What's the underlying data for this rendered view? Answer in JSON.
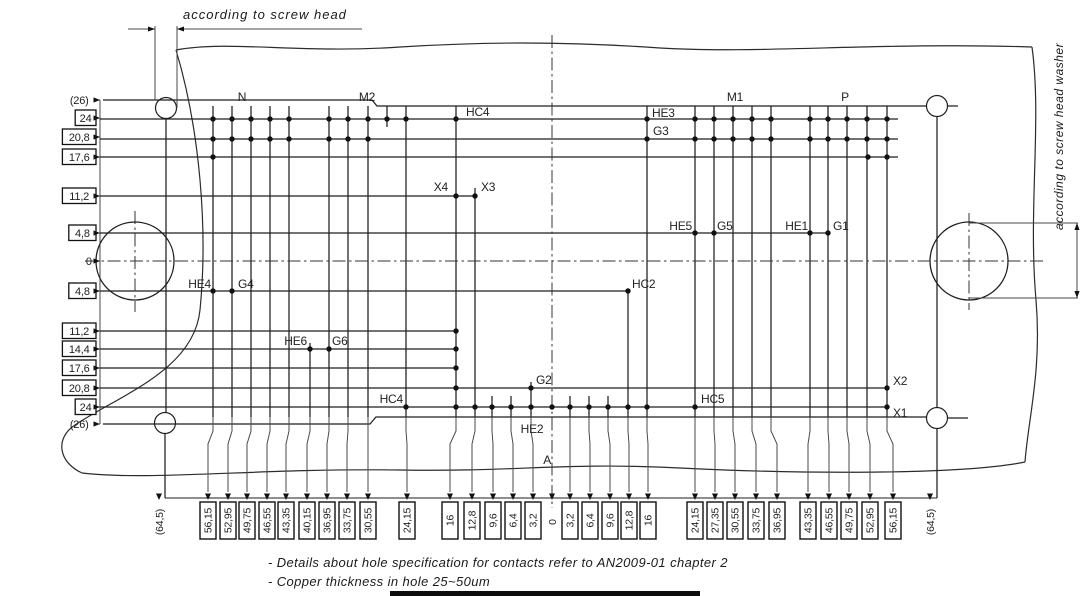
{
  "annotations": {
    "screw_head": "according to screw head",
    "screw_washer": "according to screw head washer"
  },
  "notes": [
    "- Details about hole specification for contacts refer to AN2009-01 chapter 2",
    "- Copper thickness in hole 25~50um"
  ],
  "colors": {
    "line": "#1f1f1f",
    "leader": "#4a4a4a",
    "text": "#222222",
    "background": "#ffffff",
    "bottom_bar": "#0d0d0d"
  },
  "left_dimensions": [
    {
      "label": "(26)",
      "y": 100,
      "boxed": false
    },
    {
      "label": "24",
      "y": 118,
      "boxed": true
    },
    {
      "label": "20,8",
      "y": 137,
      "boxed": true
    },
    {
      "label": "17,6",
      "y": 157,
      "boxed": true
    },
    {
      "label": "11,2",
      "y": 196,
      "boxed": true
    },
    {
      "label": "4,8",
      "y": 233,
      "boxed": true
    },
    {
      "label": "0",
      "y": 261,
      "boxed": false
    },
    {
      "label": "4,8",
      "y": 291,
      "boxed": true
    },
    {
      "label": "11,2",
      "y": 331,
      "boxed": true
    },
    {
      "label": "14,4",
      "y": 349,
      "boxed": true
    },
    {
      "label": "17,6",
      "y": 368,
      "boxed": true
    },
    {
      "label": "20,8",
      "y": 388,
      "boxed": true
    },
    {
      "label": "24",
      "y": 407,
      "boxed": true
    },
    {
      "label": "(26)",
      "y": 424,
      "boxed": false
    }
  ],
  "bottom_dimensions": [
    {
      "label": "(64,5)",
      "col": 165,
      "x": 159,
      "boxed": false
    },
    {
      "label": "56,15",
      "col": 213,
      "x": 208,
      "boxed": true
    },
    {
      "label": "52,95",
      "col": 232,
      "x": 228,
      "boxed": true
    },
    {
      "label": "49,75",
      "col": 251,
      "x": 247,
      "boxed": true
    },
    {
      "label": "46,55",
      "col": 270,
      "x": 267,
      "boxed": true
    },
    {
      "label": "43,35",
      "col": 289,
      "x": 286,
      "boxed": true
    },
    {
      "label": "40,15",
      "col": 310,
      "x": 307,
      "boxed": true
    },
    {
      "label": "36,95",
      "col": 329,
      "x": 327,
      "boxed": true
    },
    {
      "label": "33,75",
      "col": 348,
      "x": 347,
      "boxed": true
    },
    {
      "label": "30,55",
      "col": 368,
      "x": 368,
      "boxed": true
    },
    {
      "label": "24,15",
      "col": 406,
      "x": 407,
      "boxed": true
    },
    {
      "label": "16",
      "col": 456,
      "x": 450,
      "boxed": true
    },
    {
      "label": "12,8",
      "col": 475,
      "x": 472,
      "boxed": true
    },
    {
      "label": "9,6",
      "col": 492,
      "x": 493,
      "boxed": true
    },
    {
      "label": "6,4",
      "col": 511,
      "x": 513,
      "boxed": true
    },
    {
      "label": "3,2",
      "col": 531,
      "x": 533,
      "boxed": true
    },
    {
      "label": "0",
      "col": 552,
      "x": 552,
      "boxed": false
    },
    {
      "label": "3,2",
      "col": 570,
      "x": 570,
      "boxed": true
    },
    {
      "label": "6,4",
      "col": 589,
      "x": 590,
      "boxed": true
    },
    {
      "label": "9,6",
      "col": 608,
      "x": 610,
      "boxed": true
    },
    {
      "label": "12,8",
      "col": 628,
      "x": 629,
      "boxed": true
    },
    {
      "label": "16",
      "col": 647,
      "x": 648,
      "boxed": true
    },
    {
      "label": "24,15",
      "col": 695,
      "x": 695,
      "boxed": true
    },
    {
      "label": "27,35",
      "col": 714,
      "x": 715,
      "boxed": true
    },
    {
      "label": "30,55",
      "col": 733,
      "x": 735,
      "boxed": true
    },
    {
      "label": "33,75",
      "col": 752,
      "x": 756,
      "boxed": true
    },
    {
      "label": "36,95",
      "col": 771,
      "x": 777,
      "boxed": true
    },
    {
      "label": "43,35",
      "col": 810,
      "x": 808,
      "boxed": true
    },
    {
      "label": "46,55",
      "col": 828,
      "x": 829,
      "boxed": true
    },
    {
      "label": "49,75",
      "col": 847,
      "x": 849,
      "boxed": true
    },
    {
      "label": "52,95",
      "col": 867,
      "x": 870,
      "boxed": true
    },
    {
      "label": "56,15",
      "col": 887,
      "x": 893,
      "boxed": true
    },
    {
      "label": "(64,5)",
      "col": 937,
      "x": 930,
      "boxed": false
    }
  ],
  "part_labels": [
    {
      "text": "N",
      "x": 242,
      "y": 101,
      "anchor": "middle"
    },
    {
      "text": "M2",
      "x": 367,
      "y": 101,
      "anchor": "middle"
    },
    {
      "text": "HC4",
      "x": 466,
      "y": 116,
      "anchor": "start"
    },
    {
      "text": "HE3",
      "x": 652,
      "y": 117,
      "anchor": "start"
    },
    {
      "text": "G3",
      "x": 653,
      "y": 135,
      "anchor": "start"
    },
    {
      "text": "M1",
      "x": 735,
      "y": 101,
      "anchor": "middle"
    },
    {
      "text": "P",
      "x": 845,
      "y": 101,
      "anchor": "middle"
    },
    {
      "text": "X4",
      "x": 448,
      "y": 191,
      "anchor": "end"
    },
    {
      "text": "X3",
      "x": 481,
      "y": 191,
      "anchor": "start"
    },
    {
      "text": "HE5",
      "x": 692,
      "y": 230,
      "anchor": "end"
    },
    {
      "text": "G5",
      "x": 717,
      "y": 230,
      "anchor": "start"
    },
    {
      "text": "HE1",
      "x": 808,
      "y": 230,
      "anchor": "end"
    },
    {
      "text": "G1",
      "x": 833,
      "y": 230,
      "anchor": "start"
    },
    {
      "text": "HE4",
      "x": 211,
      "y": 288,
      "anchor": "end"
    },
    {
      "text": "G4",
      "x": 238,
      "y": 288,
      "anchor": "start"
    },
    {
      "text": "HC2",
      "x": 632,
      "y": 288,
      "anchor": "start"
    },
    {
      "text": "HE6",
      "x": 307,
      "y": 345,
      "anchor": "end"
    },
    {
      "text": "G6",
      "x": 332,
      "y": 345,
      "anchor": "start"
    },
    {
      "text": "G2",
      "x": 536,
      "y": 384,
      "anchor": "start"
    },
    {
      "text": "HC5",
      "x": 701,
      "y": 403,
      "anchor": "start"
    },
    {
      "text": "X2",
      "x": 893,
      "y": 385,
      "anchor": "start"
    },
    {
      "text": "X1",
      "x": 893,
      "y": 417,
      "anchor": "start"
    },
    {
      "text": "HC4",
      "x": 403,
      "y": 403,
      "anchor": "end"
    },
    {
      "text": "HE2",
      "x": 532,
      "y": 433,
      "anchor": "middle"
    },
    {
      "text": "A",
      "x": 551,
      "y": 464,
      "anchor": "end"
    }
  ],
  "drawing": {
    "outline_paths": [
      "M 176 50 C 230 40 300 54 400 47 C 480 42 560 41 660 48 C 760 54 880 42 1032 47",
      "M 176 50 C 200 130 208 230 200 310 C 194 370 120 395 75 425 C 55 438 58 462 82 473",
      "M 82 473 C 150 481 260 468 400 470 C 520 472 560 462 680 468 C 800 474 960 475 1025 462",
      "M 1032 47 C 1042 120 1028 210 1036 300 C 1042 370 1028 420 1025 462"
    ],
    "rows": [
      [
        100,
        898,
        119
      ],
      [
        100,
        898,
        139
      ],
      [
        100,
        898,
        157
      ],
      [
        100,
        475,
        196
      ],
      [
        100,
        828,
        233
      ],
      [
        100,
        628,
        291
      ],
      [
        100,
        455,
        331
      ],
      [
        100,
        455,
        349
      ],
      [
        100,
        455,
        368
      ],
      [
        100,
        887,
        388
      ],
      [
        100,
        887,
        407
      ]
    ],
    "profile": [
      [
        [
          103,
          100
        ],
        [
          372,
          100
        ],
        [
          377,
          106
        ],
        [
          926,
          106
        ]
      ],
      [
        [
          947,
          106
        ],
        [
          958,
          106
        ]
      ],
      [
        [
          103,
          424
        ],
        [
          370,
          424
        ],
        [
          376,
          417
        ],
        [
          926,
          417
        ]
      ],
      [
        [
          948,
          418
        ],
        [
          968,
          418
        ]
      ]
    ],
    "cols": [
      [
        213,
        106,
        417
      ],
      [
        232,
        106,
        417
      ],
      [
        251,
        106,
        417
      ],
      [
        270,
        106,
        417
      ],
      [
        289,
        106,
        417
      ],
      [
        310,
        343,
        417
      ],
      [
        329,
        106,
        417
      ],
      [
        348,
        106,
        417
      ],
      [
        368,
        106,
        417
      ],
      [
        387,
        106,
        127
      ],
      [
        406,
        106,
        417
      ],
      [
        456,
        106,
        417
      ],
      [
        475,
        188,
        417
      ],
      [
        492,
        396,
        417
      ],
      [
        511,
        396,
        417
      ],
      [
        531,
        382,
        417
      ],
      [
        570,
        396,
        417
      ],
      [
        589,
        396,
        417
      ],
      [
        608,
        396,
        417
      ],
      [
        628,
        291,
        417
      ],
      [
        647,
        106,
        417
      ],
      [
        695,
        106,
        417
      ],
      [
        714,
        106,
        417
      ],
      [
        733,
        106,
        417
      ],
      [
        752,
        106,
        417
      ],
      [
        771,
        106,
        417
      ],
      [
        810,
        106,
        417
      ],
      [
        828,
        106,
        417
      ],
      [
        847,
        106,
        417
      ],
      [
        867,
        106,
        417
      ],
      [
        887,
        106,
        417
      ],
      [
        166,
        119,
        412
      ],
      [
        937,
        117,
        407
      ]
    ],
    "left_tie": [
      100,
      100,
      424
    ],
    "dashdot": {
      "horizontal": [
        85,
        1046,
        261
      ],
      "vertical_center": [
        552,
        35,
        508
      ],
      "cross_left": [
        135,
        211,
        312
      ],
      "cross_right": [
        969,
        213,
        310
      ]
    },
    "pins": [
      [
        119,
        [
          213,
          232,
          251,
          270,
          289,
          329,
          348,
          368,
          387,
          406,
          456,
          647,
          695,
          714,
          733,
          752,
          771,
          810,
          828,
          847,
          867,
          887
        ]
      ],
      [
        139,
        [
          213,
          232,
          251,
          270,
          289,
          329,
          348,
          368,
          647,
          695,
          714,
          733,
          752,
          771,
          810,
          828,
          847,
          867,
          887
        ]
      ],
      [
        157,
        [
          213,
          868,
          887
        ]
      ],
      [
        196,
        [
          456,
          475
        ]
      ],
      [
        233,
        [
          695,
          714,
          810,
          828
        ]
      ],
      [
        291,
        [
          213,
          232,
          628
        ]
      ],
      [
        331,
        [
          456
        ]
      ],
      [
        349,
        [
          310,
          329,
          456
        ]
      ],
      [
        368,
        [
          456
        ]
      ],
      [
        388,
        [
          456,
          531,
          887
        ]
      ],
      [
        407,
        [
          406,
          456,
          475,
          492,
          511,
          531,
          552,
          570,
          589,
          608,
          628,
          647,
          695,
          887
        ]
      ]
    ],
    "screw_holes": [
      [
        166,
        108
      ],
      [
        937,
        106
      ],
      [
        165,
        423
      ],
      [
        937,
        418
      ]
    ],
    "screw_hole_radius": 10.5,
    "mounting_holes": [
      [
        135,
        261
      ],
      [
        969,
        261
      ]
    ],
    "mounting_hole_radius": 39,
    "screw_dim": {
      "ext_lines": [
        [
          155,
          26,
          100
        ],
        [
          177,
          26,
          108
        ]
      ],
      "dim_y": 29,
      "left_seg": [
        128,
        155
      ],
      "right_seg": [
        177,
        362
      ]
    },
    "washer_dim": {
      "ext_top": [
        969,
        1078,
        223
      ],
      "ext_bottom": [
        969,
        1078,
        298
      ],
      "dim_x": 1077
    },
    "baseline": {
      "x1": 165,
      "x2": 937,
      "y": 498
    },
    "outer_dim_drops": [
      [
        165,
        433,
        498
      ],
      [
        937,
        429,
        498
      ]
    ]
  }
}
